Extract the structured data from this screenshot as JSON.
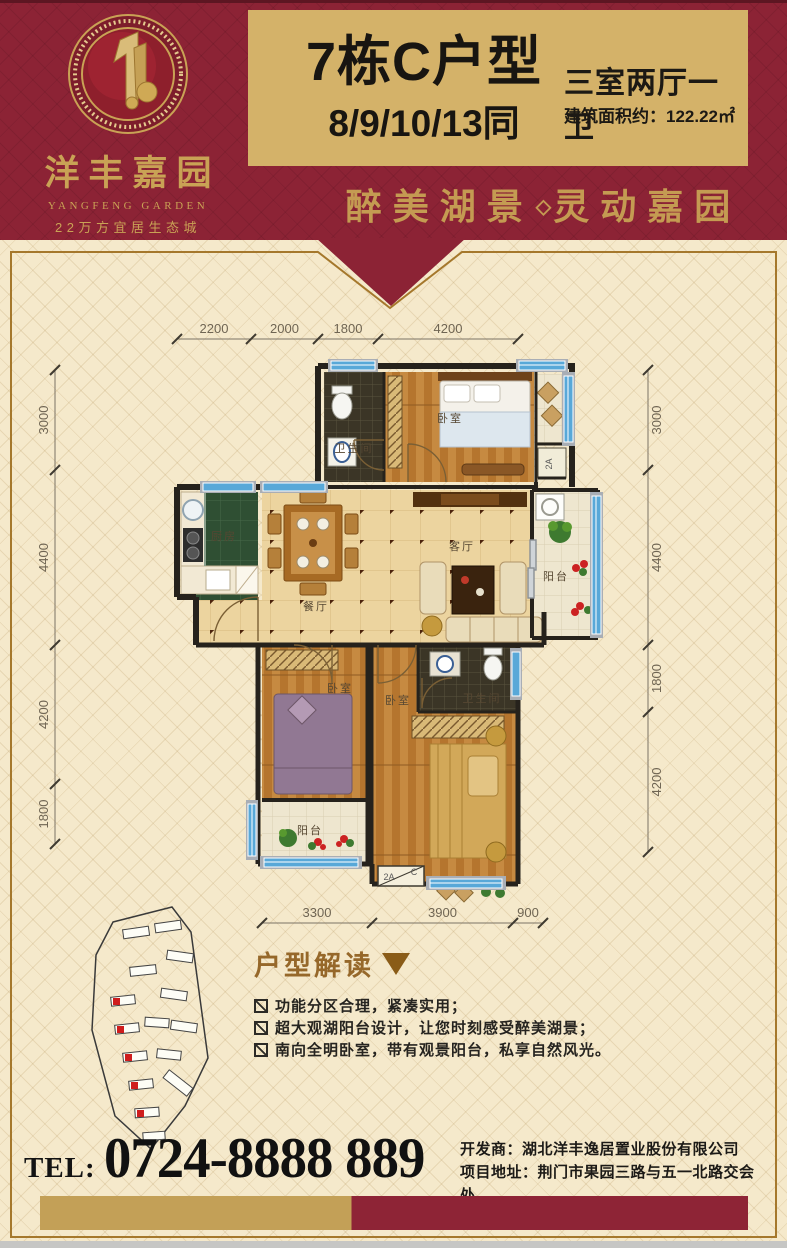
{
  "poster": {
    "logo": {
      "name_cn": "洋丰嘉园",
      "name_en": "YANGFENG GARDEN",
      "tagline": "22万方宜居生态城"
    },
    "title": {
      "unit": "7栋C户型",
      "floors": "8/9/10/13同",
      "layout_spec": "三室两厅一卫",
      "area_line": "建筑面积约：122.22㎡"
    },
    "slogan": {
      "left": "醉美湖景",
      "diamond": "◇",
      "right": "灵动嘉园"
    },
    "floorplan": {
      "rooms": [
        "卫生间",
        "卧室",
        "厨房",
        "餐厅",
        "客厅",
        "阳台",
        "卧室",
        "卧室",
        "卫生间",
        "阳台"
      ],
      "dims": {
        "top": [
          "2200",
          "2000",
          "1800",
          "4200"
        ],
        "left": [
          "3000",
          "4400",
          "4200",
          "1800"
        ],
        "right": [
          "3000",
          "4400",
          "1800",
          "4200"
        ],
        "bottom": [
          "3300",
          "3900",
          "900"
        ]
      },
      "unit_box_left": "2A",
      "unit_box_right": "C",
      "shaft_label": "2A"
    },
    "analysis": {
      "title": "户型解读",
      "bullets": [
        "功能分区合理，紧凑实用；",
        "超大观湖阳台设计，让您时刻感受醉美湖景；",
        "南向全明卧室，带有观景阳台，私享自然风光。"
      ]
    },
    "contact": {
      "tel_label": "TEL:",
      "tel_number": "0724-8888 889",
      "developer_line": "开发商：湖北洋丰逸居置业股份有限公司",
      "address_line": "项目地址：荆门市果园三路与五一北路交会处"
    },
    "colors": {
      "header_red": "#8c2335",
      "gold_panel": "#d4b269",
      "gold_text": "#c49b52",
      "body_bg": "#f5e9cb",
      "frame_gold": "#a5782c",
      "accent_brown": "#96682a",
      "bar_gold": "#c3a057",
      "bar_red": "#8e2436",
      "window_blue": "#58a8d8"
    }
  }
}
